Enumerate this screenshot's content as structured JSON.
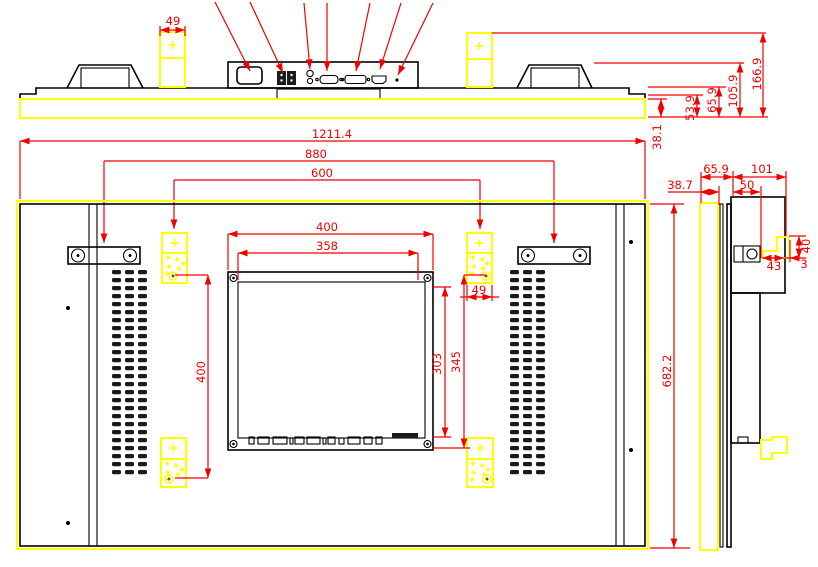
{
  "drawing": {
    "kind": "technical-dimension-drawing",
    "subject": "wall-mount display panel",
    "views": [
      "top-view",
      "rear-view",
      "side-view"
    ],
    "colors": {
      "outline": "#000000",
      "dimension": "#f10000",
      "highlight": "#ffff00",
      "background": "#ffffff"
    }
  },
  "dimensions_mm": {
    "top_view": {
      "bracket_width": "49"
    },
    "widths": {
      "overall": "1211.4",
      "handle_centers": "880",
      "mount_centers": "600"
    },
    "depth_stack": {
      "front": "38.1",
      "step": "53.9",
      "body": "65.9",
      "to_handle": "105.9",
      "total": "166.9"
    },
    "rear_view": {
      "module_width": "400",
      "module_opening_width": "358",
      "opening_height": "303",
      "module_height": "345",
      "bracket_width": "49",
      "mount_vertical": "400",
      "overall_height": "682.2"
    },
    "side_view": {
      "front_depth": "38.7",
      "body_depth": "65.9",
      "box_depth": "101",
      "rail_depth": "50",
      "hook_height": "40",
      "hook_width": "43",
      "hook_offset": "3"
    }
  }
}
